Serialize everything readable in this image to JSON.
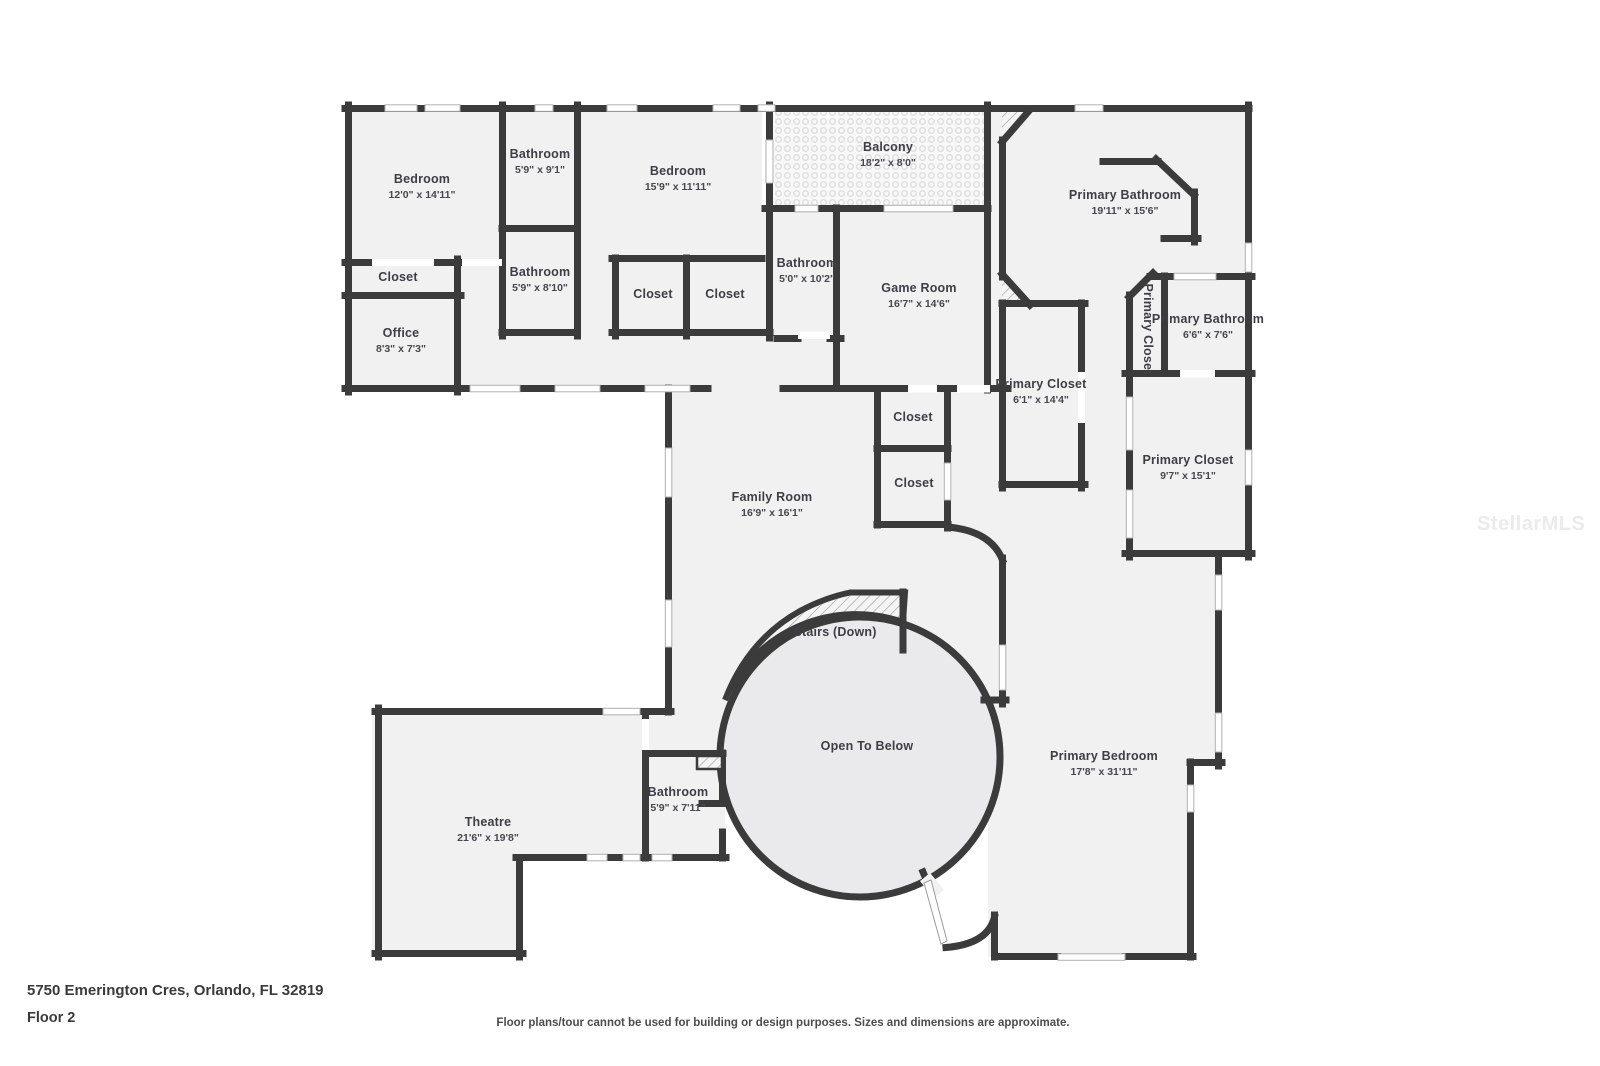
{
  "plan": {
    "address": "5750 Emerington Cres, Orlando, FL 32819",
    "floor_label": "Floor 2",
    "disclaimer": "Floor plans/tour cannot be used for building or design purposes. Sizes and dimensions are approximate.",
    "watermark": "StellarMLS",
    "colors": {
      "wall": "#3b3b3b",
      "room_fill": "#f1f1f2",
      "rotunda_fill": "#eaeaec",
      "label_text": "#3e3e45"
    },
    "rooms": [
      {
        "id": "bedroom-1",
        "name": "Bedroom",
        "dims": "12'0\" x 14'11\"",
        "x": 422,
        "y": 187
      },
      {
        "id": "bathroom-1",
        "name": "Bathroom",
        "dims": "5'9\" x 9'1\"",
        "x": 540,
        "y": 162
      },
      {
        "id": "bedroom-2",
        "name": "Bedroom",
        "dims": "15'9\" x 11'11\"",
        "x": 678,
        "y": 179
      },
      {
        "id": "balcony",
        "name": "Balcony",
        "dims": "18'2\" x 8'0\"",
        "x": 888,
        "y": 155
      },
      {
        "id": "primary-bathroom",
        "name": "Primary Bathroom",
        "dims": "19'11\" x 15'6\"",
        "x": 1125,
        "y": 203
      },
      {
        "id": "closet-1",
        "name": "Closet",
        "dims": "",
        "x": 398,
        "y": 278
      },
      {
        "id": "bathroom-2",
        "name": "Bathroom",
        "dims": "5'9\" x 8'10\"",
        "x": 540,
        "y": 280
      },
      {
        "id": "office",
        "name": "Office",
        "dims": "8'3\" x 7'3\"",
        "x": 401,
        "y": 341
      },
      {
        "id": "closet-2",
        "name": "Closet",
        "dims": "",
        "x": 653,
        "y": 295
      },
      {
        "id": "closet-3",
        "name": "Closet",
        "dims": "",
        "x": 725,
        "y": 295
      },
      {
        "id": "bathroom-3",
        "name": "Bathroom",
        "dims": "5'0\" x 10'2\"",
        "x": 807,
        "y": 271
      },
      {
        "id": "game-room",
        "name": "Game Room",
        "dims": "16'7\" x 14'6\"",
        "x": 919,
        "y": 296
      },
      {
        "id": "primary-closet-1",
        "name": "Primary Closet",
        "dims": "",
        "x": 1147,
        "y": 329,
        "vertical": true
      },
      {
        "id": "primary-bathroom-2",
        "name": "Primary Bathroom",
        "dims": "6'6\" x 7'6\"",
        "x": 1208,
        "y": 327
      },
      {
        "id": "primary-closet-2",
        "name": "Primary Closet",
        "dims": "6'1\" x 14'4\"",
        "x": 1041,
        "y": 392
      },
      {
        "id": "primary-closet-3",
        "name": "Primary Closet",
        "dims": "9'7\" x 15'1\"",
        "x": 1188,
        "y": 468
      },
      {
        "id": "closet-4",
        "name": "Closet",
        "dims": "",
        "x": 913,
        "y": 418
      },
      {
        "id": "closet-5",
        "name": "Closet",
        "dims": "",
        "x": 914,
        "y": 484
      },
      {
        "id": "family-room",
        "name": "Family Room",
        "dims": "16'9\" x 16'1\"",
        "x": 772,
        "y": 505
      },
      {
        "id": "stairs-down",
        "name": "Stairs (Down)",
        "dims": "",
        "x": 835,
        "y": 633
      },
      {
        "id": "open-to-below",
        "name": "Open To Below",
        "dims": "",
        "x": 867,
        "y": 747
      },
      {
        "id": "primary-bedroom",
        "name": "Primary Bedroom",
        "dims": "17'8\" x 31'11\"",
        "x": 1104,
        "y": 764
      },
      {
        "id": "theatre",
        "name": "Theatre",
        "dims": "21'6\" x 19'8\"",
        "x": 488,
        "y": 830
      },
      {
        "id": "bathroom-4",
        "name": "Bathroom",
        "dims": "5'9\" x 7'11\"",
        "x": 678,
        "y": 800
      }
    ]
  }
}
